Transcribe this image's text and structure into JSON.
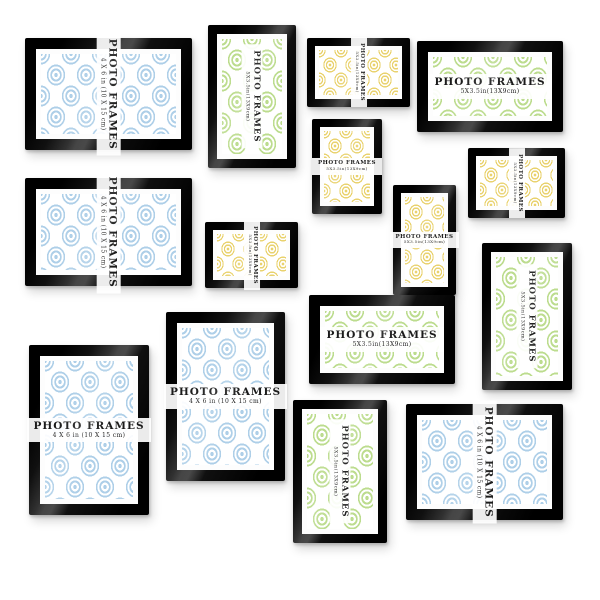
{
  "page": {
    "description": "Wall gallery set of 15 black photo frames with patterned inserts"
  },
  "colors": {
    "frame_black": "#0e0e0e",
    "mat_white": "#fdfdfd",
    "blue": "#aecfe8",
    "green": "#bcdc8e",
    "yellow": "#e9d26e",
    "label_text": "#1b1b1b"
  },
  "labels": {
    "title": "PHOTO FRAMES",
    "size_4x6": "4 X 6 in (10 X 15 cm)",
    "size_5x35": "5X3.5in(13X9cm)"
  },
  "frames": [
    {
      "id": 1,
      "color": "blue",
      "orientation": "landscape",
      "label_direction": "vertical",
      "title": "PHOTO FRAMES",
      "size": "4 X 6 in (10 X 15 cm)"
    },
    {
      "id": 2,
      "color": "green",
      "orientation": "portrait",
      "label_direction": "vertical",
      "title": "PHOTO FRAMES",
      "size": "5X3.5in(13X9cm)"
    },
    {
      "id": 3,
      "color": "yellow",
      "orientation": "landscape",
      "label_direction": "vertical",
      "title": "PHOTO FRAMES",
      "size": "5X3.5in(13X9cm)"
    },
    {
      "id": 4,
      "color": "green",
      "orientation": "landscape",
      "label_direction": "horizontal",
      "title": "PHOTO FRAMES",
      "size": "5X3.5in(13X9cm)"
    },
    {
      "id": 5,
      "color": "blue",
      "orientation": "landscape",
      "label_direction": "vertical",
      "title": "PHOTO FRAMES",
      "size": "4 X 6 in (10 X 15 cm)"
    },
    {
      "id": 6,
      "color": "yellow",
      "orientation": "portrait",
      "label_direction": "horizontal",
      "title": "PHOTO FRAMES",
      "size": "5X3.5in(13X9cm)"
    },
    {
      "id": 7,
      "color": "yellow",
      "orientation": "landscape",
      "label_direction": "vertical",
      "title": "PHOTO FRAMES",
      "size": "5X3.5in(13X9cm)"
    },
    {
      "id": 8,
      "color": "yellow",
      "orientation": "portrait",
      "label_direction": "horizontal",
      "title": "PHOTO FRAMES",
      "size": "5X3.5in(13X9cm)"
    },
    {
      "id": 9,
      "color": "yellow",
      "orientation": "landscape",
      "label_direction": "vertical",
      "title": "PHOTO FRAMES",
      "size": "5X3.5in(13X9cm)"
    },
    {
      "id": 10,
      "color": "green",
      "orientation": "landscape",
      "label_direction": "horizontal",
      "title": "PHOTO FRAMES",
      "size": "5X3.5in(13X9cm)"
    },
    {
      "id": 11,
      "color": "green",
      "orientation": "portrait",
      "label_direction": "vertical",
      "title": "PHOTO FRAMES",
      "size": "5X3.5in(13X9cm)"
    },
    {
      "id": 12,
      "color": "blue",
      "orientation": "portrait",
      "label_direction": "horizontal",
      "title": "PHOTO FRAMES",
      "size": "4 X 6 in (10 X 15 cm)"
    },
    {
      "id": 13,
      "color": "blue",
      "orientation": "portrait",
      "label_direction": "horizontal",
      "title": "PHOTO FRAMES",
      "size": "4 X 6 in (10 X 15 cm)"
    },
    {
      "id": 14,
      "color": "green",
      "orientation": "portrait",
      "label_direction": "vertical",
      "title": "PHOTO FRAMES",
      "size": "5X3.5in(13X9cm)"
    },
    {
      "id": 15,
      "color": "blue",
      "orientation": "landscape",
      "label_direction": "vertical",
      "title": "PHOTO FRAMES",
      "size": "4 X 6 in (10 X 15 cm)"
    }
  ]
}
